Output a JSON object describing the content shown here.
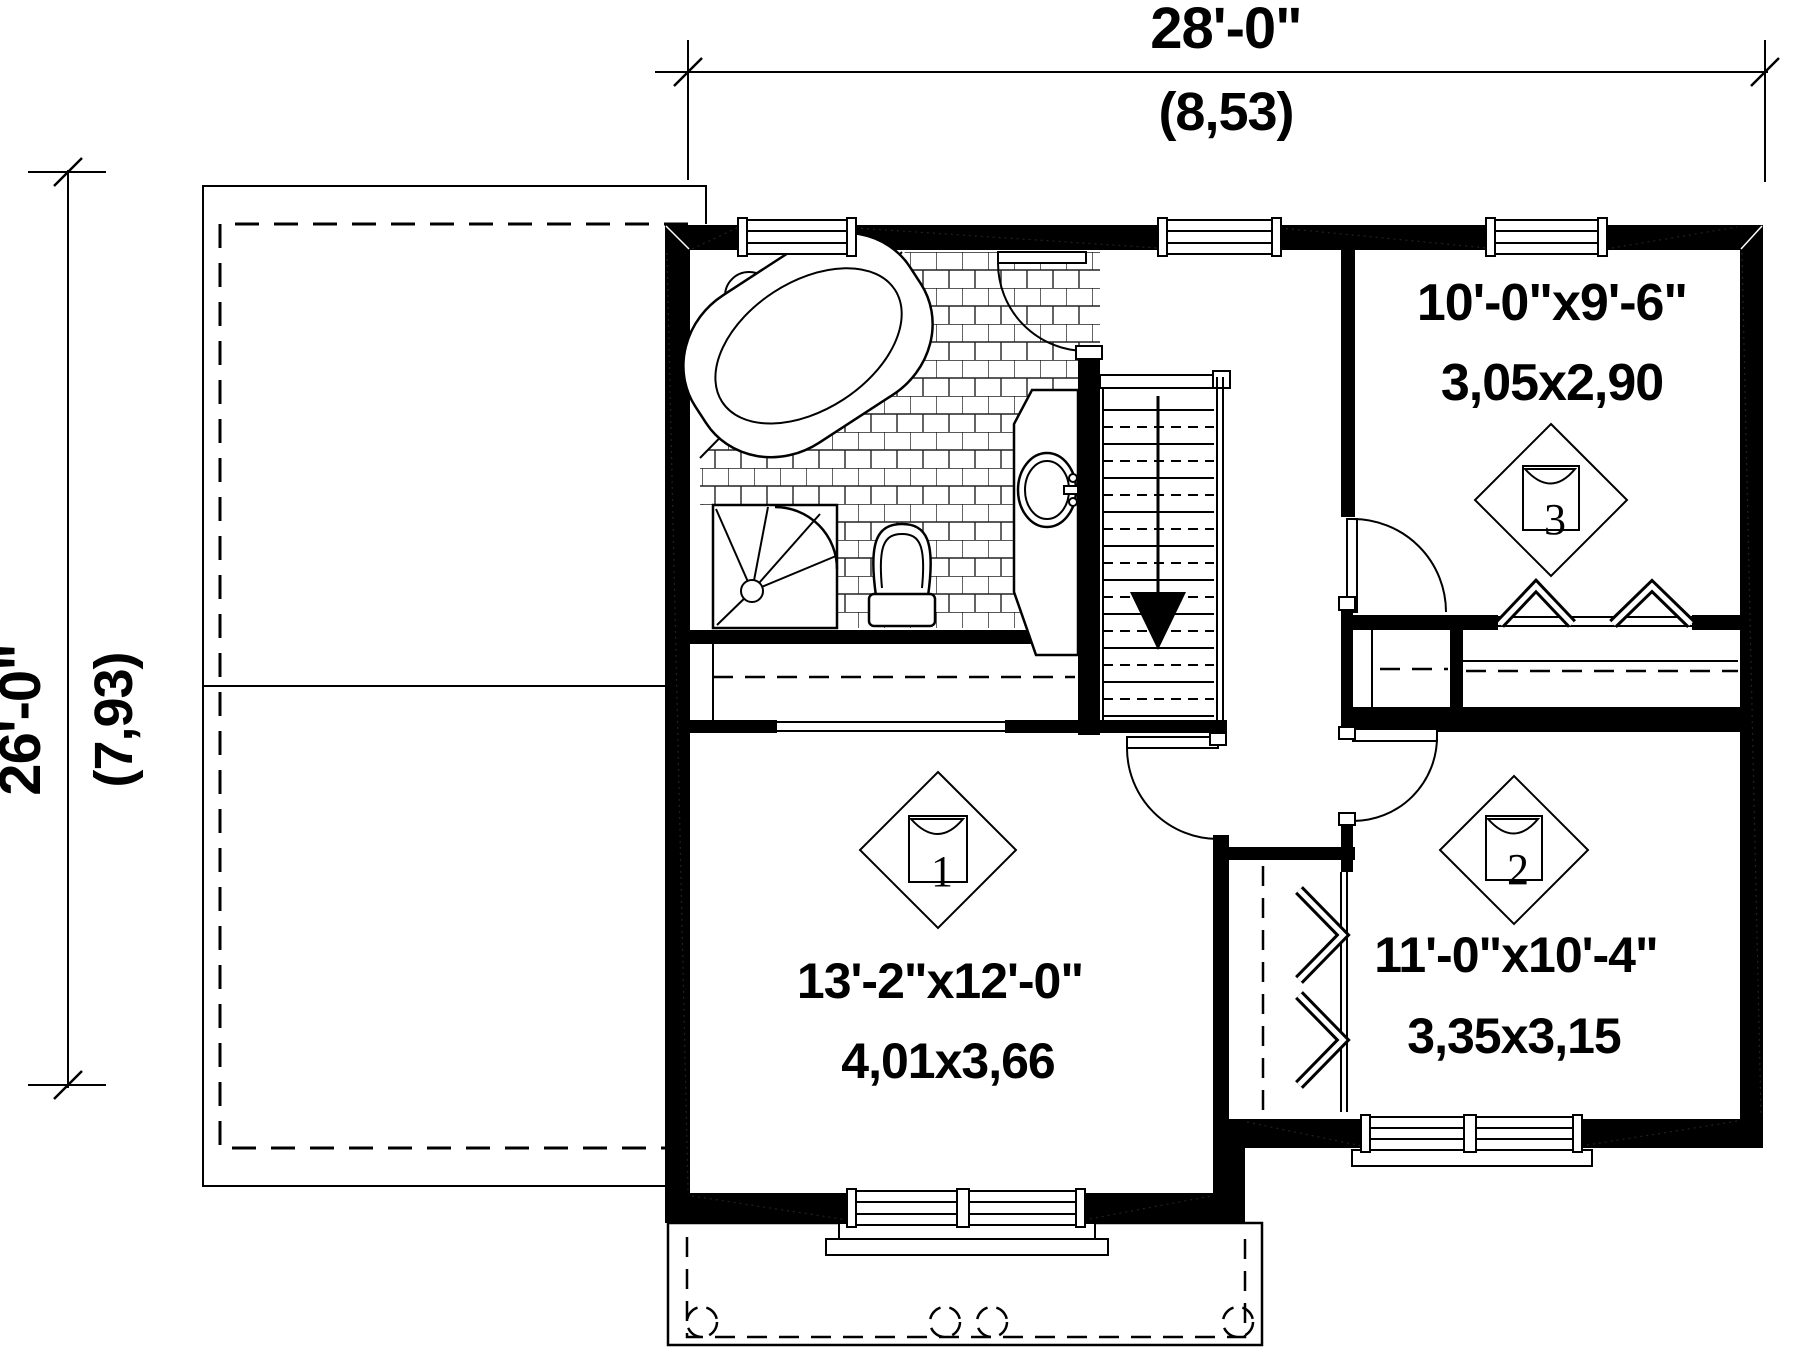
{
  "colors": {
    "line": "#000000",
    "background": "#ffffff"
  },
  "dimensions": {
    "width": {
      "imperial": "28'-0\"",
      "metric": "(8,53)"
    },
    "depth": {
      "imperial": "26'-0\"",
      "metric": "(7,93)"
    }
  },
  "rooms": [
    {
      "number": "1",
      "size_imperial": "13'-2\"x12'-0\"",
      "size_metric": "4,01x3,66"
    },
    {
      "number": "2",
      "size_imperial": "11'-0\"x10'-4\"",
      "size_metric": "3,35x3,15"
    },
    {
      "number": "3",
      "size_imperial": "10'-0\"x9'-6\"",
      "size_metric": "3,05x2,90"
    }
  ]
}
